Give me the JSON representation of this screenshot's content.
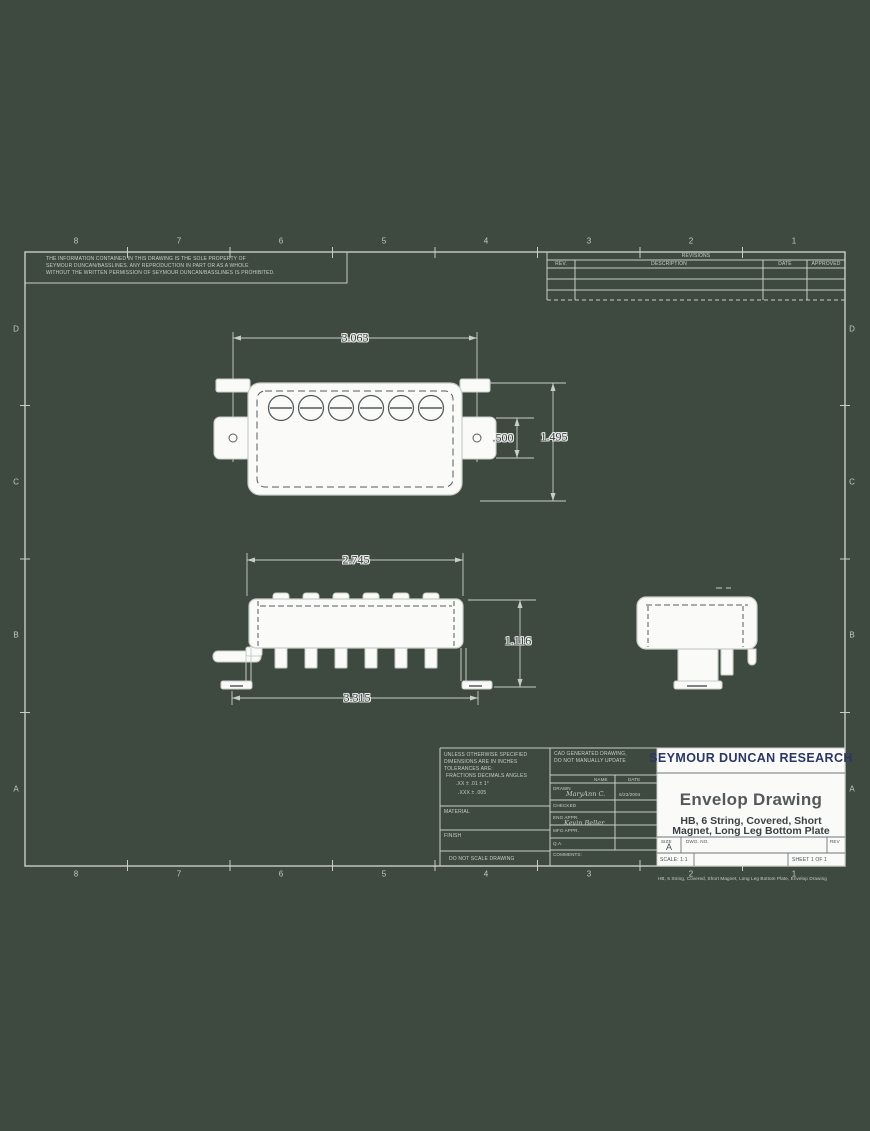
{
  "background_color": "#3e4a40",
  "grid": {
    "top": [
      "8",
      "7",
      "6",
      "5",
      "4",
      "3",
      "2",
      "1"
    ],
    "bottom": [
      "8",
      "7",
      "6",
      "5",
      "4",
      "3",
      "2",
      "1"
    ],
    "left": [
      "D",
      "C",
      "B",
      "A"
    ],
    "right": [
      "D",
      "C",
      "B",
      "A"
    ]
  },
  "notice": {
    "lines": [
      "THE INFORMATION CONTAINED IN THIS DRAWING IS THE SOLE PROPERTY OF",
      "SEYMOUR DUNCAN/BASSLINES.  ANY REPRODUCTION IN PART OR AS A WHOLE",
      "WITHOUT THE WRITTEN PERMISSION OF SEYMOUR DUNCAN/BASSLINES IS PROHIBITED."
    ]
  },
  "revision_table": {
    "title": "REVISIONS",
    "columns": [
      "REV.",
      "DESCRIPTION",
      "DATE",
      "APPROVED"
    ]
  },
  "dimensions": {
    "top_view_width": "3.063",
    "top_view_tab_height": ".500",
    "top_view_overall_height": "1.495",
    "side_view_cover_width": "2.745",
    "side_view_overall_height": "1.116",
    "side_view_baseplate_width": "3.315"
  },
  "title_block": {
    "company": "SEYMOUR DUNCAN RESEARCH",
    "drawing_title": "Envelop Drawing",
    "subtitle_line1": "HB, 6 String, Covered, Short",
    "subtitle_line2": "Magnet, Long Leg Bottom Plate",
    "tolerance_lines": [
      "UNLESS OTHERWISE SPECIFIED",
      "DIMENSIONS ARE IN INCHES",
      "TOLERANCES ARE:",
      "FRACTIONS   DECIMALS   ANGLES",
      ".XX ± .01      ± 1°",
      ".XXX ± .005"
    ],
    "material_label": "MATERIAL",
    "finish_label": "FINISH",
    "do_not_scale": "DO NOT SCALE DRAWING",
    "cad_note_line1": "CAD GENERATED DRAWING,",
    "cad_note_line2": "DO NOT MANUALLY UPDATE",
    "name_header": "NAME",
    "date_header": "DATE",
    "rows": [
      {
        "label": "DRAWN",
        "name": "MaryAnn C.",
        "date": "6/23/2004"
      },
      {
        "label": "CHECKED",
        "name": "",
        "date": ""
      },
      {
        "label": "ENG APPR.",
        "name": "Kevin Beller",
        "date": ""
      },
      {
        "label": "MFG APPR.",
        "name": "",
        "date": ""
      },
      {
        "label": "Q.A.",
        "name": "",
        "date": ""
      },
      {
        "label": "COMMENTS:",
        "name": "",
        "date": ""
      }
    ],
    "size_label": "SIZE",
    "size_value": "A",
    "dwg_no_label": "DWG. NO.",
    "rev_label": "REV",
    "scale_text": "SCALE: 1:1",
    "sheet_text": "SHEET 1 OF 1"
  },
  "footer_note": "HB, 6 String, Covered, Short Magnet, Long Leg Bottom Plate, Envelop Drawing"
}
